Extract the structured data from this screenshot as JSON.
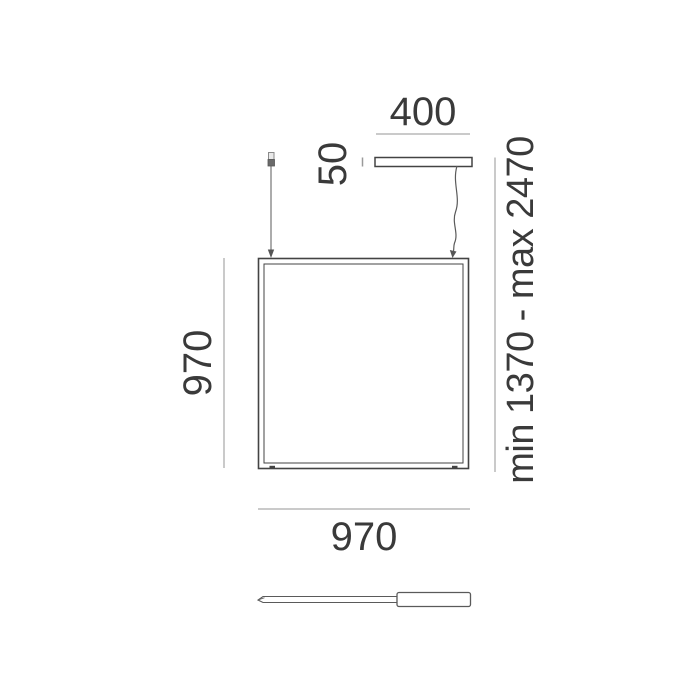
{
  "figure": {
    "kind": "technical-dimension-drawing",
    "subject": "square suspension lamp with ceiling canopy, suspension cables and control tool",
    "labels": {
      "canopy_width": "400",
      "canopy_height": "50",
      "panel_height": "970",
      "panel_width": "970",
      "suspension_range": "min 1370 - max 2470"
    },
    "units": "mm",
    "colors": {
      "bg": "#ffffff",
      "outline": "#434343",
      "thin-outline": "#5a5a5a",
      "dim-line": "#b9b9b9",
      "tick": "#9a9a9a",
      "text": "#3a3a3a"
    }
  }
}
